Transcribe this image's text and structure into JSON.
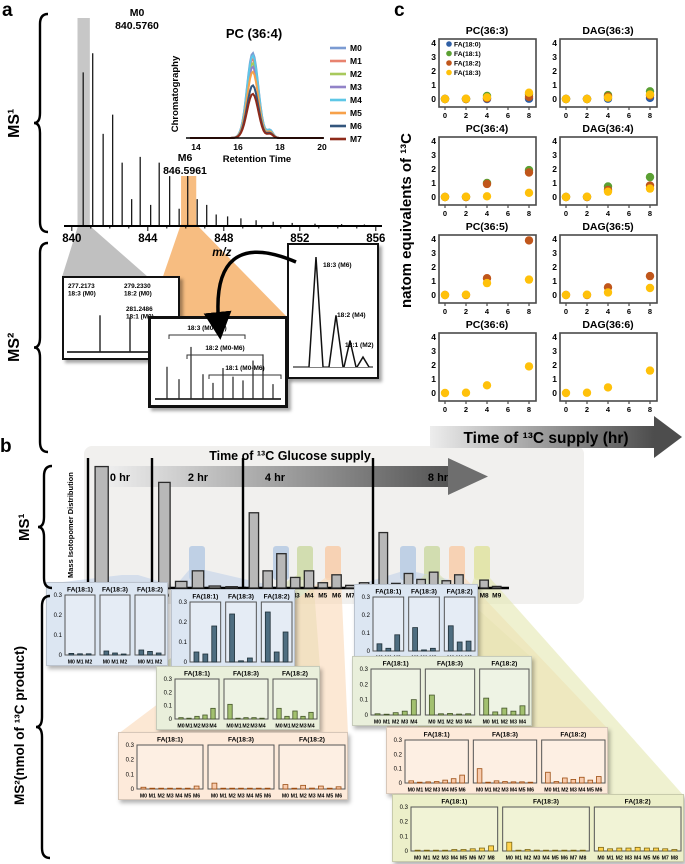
{
  "labels": {
    "a": "a",
    "b": "b",
    "c": "c"
  },
  "panel_a": {
    "ms1_side": "MS¹",
    "ms2_side": "MS²",
    "annotations": {
      "m0_name": "M0",
      "m0_mass": "840.5760",
      "m6_name": "M6",
      "m6_mass": "846.5961"
    }
  },
  "chart_data": {
    "ms1_spectrum": {
      "type": "line",
      "xlabel": "m/z",
      "xticks": [
        840,
        844,
        848,
        852,
        856
      ],
      "xlim": [
        839.8,
        856.8
      ],
      "peaks": [
        [
          840.6,
          0.8
        ],
        [
          841.1,
          0.9
        ],
        [
          841.65,
          0.48
        ],
        [
          842.15,
          0.58
        ],
        [
          842.65,
          0.33
        ],
        [
          843.15,
          0.14
        ],
        [
          843.6,
          0.36
        ],
        [
          844.15,
          0.11
        ],
        [
          844.6,
          0.33
        ],
        [
          845.15,
          0.26
        ],
        [
          845.65,
          0.09
        ],
        [
          846.1,
          0.29
        ],
        [
          846.6,
          0.14
        ],
        [
          847.1,
          0.11
        ],
        [
          847.6,
          0.06
        ],
        [
          848.2,
          0.05
        ],
        [
          848.9,
          0.04
        ],
        [
          849.7,
          0.03
        ],
        [
          850.6,
          0.022
        ],
        [
          851.6,
          0.016
        ],
        [
          852.8,
          0.012
        ],
        [
          854.2,
          0.01
        ],
        [
          855.4,
          0.008
        ]
      ],
      "highlight_gray_mz": [
        840.3,
        840.95
      ],
      "highlight_orange_mz": [
        845.75,
        846.55
      ]
    },
    "chromatogram": {
      "type": "line",
      "title": "PC (36:4)",
      "ylabel": "Chromatography",
      "xlabel": "Retention Time",
      "xticks": [
        14,
        16,
        18,
        20
      ],
      "peak_retention_time": 16.7,
      "series": [
        {
          "name": "M0",
          "color": "#7b9bd2",
          "height": 1.0
        },
        {
          "name": "M1",
          "color": "#e8836f",
          "height": 0.93
        },
        {
          "name": "M2",
          "color": "#a8c95c",
          "height": 0.88
        },
        {
          "name": "M3",
          "color": "#9283c8",
          "height": 0.84
        },
        {
          "name": "M4",
          "color": "#5ec7e6",
          "height": 0.97
        },
        {
          "name": "M5",
          "color": "#f7a14a",
          "height": 0.78
        },
        {
          "name": "M6",
          "color": "#33567d",
          "height": 0.62
        },
        {
          "name": "M7",
          "color": "#8e2a1a",
          "height": 0.52
        }
      ]
    },
    "ms2_fragment_box": {
      "type": "line",
      "peaks": [
        {
          "mass": "277.2173",
          "label": "18:3 (M0)",
          "h": 0.76
        },
        {
          "mass": "279.2330",
          "label": "18:2 (M0)",
          "h": 0.73
        },
        {
          "mass": "281.2486",
          "label": "18:1 (M0)",
          "h": 0.42
        }
      ]
    },
    "ms2_mix_box": {
      "type": "line",
      "brackets": [
        "18:3 (M0-M6)",
        "18:2 (M0-M6)",
        "18:1 (M0-M6)"
      ],
      "peak_heights": [
        0.52,
        0.32,
        0.84,
        0.4,
        0.26,
        0.5,
        0.36,
        0.3,
        0.62,
        0.72,
        0.24
      ]
    },
    "ms2_shift_box": {
      "type": "line",
      "peaks": [
        {
          "label": "18:3 (M6)",
          "h": 1.0
        },
        {
          "label": "18:2 (M4)",
          "h": 0.47
        },
        {
          "label": "18:1 (M2)",
          "h": 0.24
        },
        {
          "label": "",
          "h": 0.09
        }
      ]
    },
    "panel_c": {
      "type": "scatter",
      "ylabel": "natom equivalents of ¹³C",
      "xarrow": "Time of ¹³C supply (hr)",
      "x": [
        0,
        2,
        4,
        8
      ],
      "xticks": [
        0,
        2,
        4,
        6,
        8
      ],
      "yticks": [
        0,
        1,
        2,
        3,
        4
      ],
      "ylim": [
        0,
        4.4
      ],
      "legend": [
        {
          "name": "FA(18:0)",
          "color": "#2f5fa5"
        },
        {
          "name": "FA(18:1)",
          "color": "#5ba033"
        },
        {
          "name": "FA(18:2)",
          "color": "#c0561b"
        },
        {
          "name": "FA(18:3)",
          "color": "#ffc10a"
        }
      ],
      "plots": [
        {
          "title": "PC(36:3)",
          "legend": true,
          "series": [
            {
              "name": "FA(18:0)",
              "values": [
                0,
                0,
                0,
                0.02
              ]
            },
            {
              "name": "FA(18:1)",
              "values": [
                0,
                0,
                0.22,
                0.32
              ]
            },
            {
              "name": "FA(18:2)",
              "values": [
                0,
                0,
                0.05,
                0.15
              ]
            },
            {
              "name": "FA(18:3)",
              "values": [
                0,
                0.02,
                0.12,
                0.45
              ]
            }
          ]
        },
        {
          "title": "DAG(36:3)",
          "series": [
            {
              "name": "FA(18:0)",
              "values": [
                0,
                0,
                0.02,
                0.08
              ]
            },
            {
              "name": "FA(18:1)",
              "values": [
                0,
                0,
                0.28,
                0.55
              ]
            },
            {
              "name": "FA(18:2)",
              "values": [
                0,
                0,
                0.18,
                0.25
              ]
            },
            {
              "name": "FA(18:3)",
              "values": [
                0,
                0,
                0.1,
                0.32
              ]
            }
          ]
        },
        {
          "title": "PC(36:4)",
          "series": [
            {
              "name": "FA(18:1)",
              "values": [
                0,
                0,
                1.0,
                1.92
              ]
            },
            {
              "name": "FA(18:2)",
              "values": [
                0,
                0,
                0.93,
                1.75
              ]
            },
            {
              "name": "FA(18:3)",
              "values": [
                0,
                0.02,
                0.05,
                0.3
              ]
            }
          ]
        },
        {
          "title": "DAG(36:4)",
          "series": [
            {
              "name": "FA(18:1)",
              "values": [
                0,
                0,
                0.75,
                1.42
              ]
            },
            {
              "name": "FA(18:2)",
              "values": [
                0,
                0,
                0.5,
                0.82
              ]
            },
            {
              "name": "FA(18:3)",
              "values": [
                0,
                0.02,
                0.38,
                0.6
              ]
            }
          ]
        },
        {
          "title": "PC(36:5)",
          "series": [
            {
              "name": "FA(18:2)",
              "values": [
                0,
                0,
                1.2,
                3.9
              ]
            },
            {
              "name": "FA(18:3)",
              "values": [
                0,
                0.02,
                0.85,
                1.1
              ]
            }
          ]
        },
        {
          "title": "DAG(36:5)",
          "series": [
            {
              "name": "FA(18:2)",
              "values": [
                0,
                0,
                0.55,
                1.35
              ]
            },
            {
              "name": "FA(18:3)",
              "values": [
                0,
                0.02,
                0.18,
                0.5
              ]
            }
          ]
        },
        {
          "title": "PC(36:6)",
          "series": [
            {
              "name": "FA(18:3)",
              "values": [
                0,
                0.02,
                0.55,
                1.9
              ]
            }
          ]
        },
        {
          "title": "DAG(36:6)",
          "series": [
            {
              "name": "FA(18:3)",
              "values": [
                0,
                0.02,
                0.4,
                1.6
              ]
            }
          ]
        }
      ]
    },
    "panel_b": {
      "type": "bar",
      "header": "Time of ¹³C Glucose supply",
      "ms1_side": "MS¹",
      "ms2_side": "MS²(nmol of ¹³C product)",
      "ms1_ylabel": "Mass Isotopomer Distribution",
      "ms1_times": [
        {
          "label": "0 hr",
          "cats": [
            "M0",
            "M1",
            "M2"
          ],
          "values": [
            0.92,
            0.02,
            0.012
          ]
        },
        {
          "label": "2 hr",
          "cats": [
            "M0",
            "M1",
            "M2",
            "M3",
            "M4"
          ],
          "values": [
            0.8,
            0.05,
            0.13,
            0.015,
            0.01
          ]
        },
        {
          "label": "4 hr",
          "cats": [
            "M0",
            "M1",
            "M2",
            "M3",
            "M4",
            "M5",
            "M6",
            "M7",
            "M8"
          ],
          "values": [
            0.57,
            0.13,
            0.26,
            0.08,
            0.13,
            0.04,
            0.1,
            0.02,
            0.04
          ]
        },
        {
          "label": "8 hr",
          "cats": [
            "M0",
            "M1",
            "M2",
            "M3",
            "M4",
            "M5",
            "M6",
            "M7",
            "M8",
            "M9"
          ],
          "values": [
            0.42,
            0.035,
            0.11,
            0.065,
            0.12,
            0.055,
            0.1,
            0.025,
            0.06,
            0.012
          ]
        }
      ],
      "ms2_yticks": [
        0,
        0.1,
        0.2,
        0.3
      ],
      "ms2_boxes": [
        {
          "id": "blue-0hr",
          "bg": "#dce6f2",
          "bar": "#4e6d80",
          "edge": "#1f3038",
          "cats": [
            "M0",
            "M1",
            "M2"
          ],
          "charts": [
            {
              "title": "FA(18:1)",
              "values": [
                0.008,
                0.006,
                0.006
              ]
            },
            {
              "title": "FA(18:3)",
              "values": [
                0.02,
                0.01,
                0.005
              ]
            },
            {
              "title": "FA(18:2)",
              "values": [
                0.025,
                0.018,
                0.01
              ]
            }
          ]
        },
        {
          "id": "blue-2hr",
          "bg": "#dce6f2",
          "bar": "#4e6d80",
          "edge": "#1f3038",
          "cats": [
            "M0",
            "M1",
            "M2"
          ],
          "charts": [
            {
              "title": "FA(18:1)",
              "values": [
                0.05,
                0.04,
                0.18
              ]
            },
            {
              "title": "FA(18:3)",
              "values": [
                0.24,
                0.006,
                0.02
              ]
            },
            {
              "title": "FA(18:2)",
              "values": [
                0.25,
                0.05,
                0.15
              ]
            }
          ]
        },
        {
          "id": "blue-late",
          "bg": "#dce6f2",
          "bar": "#4e6d80",
          "edge": "#1f3038",
          "cats": [
            "M0",
            "M1",
            "M2"
          ],
          "charts": [
            {
              "title": "FA(18:1)",
              "values": [
                0.04,
                0.015,
                0.09
              ]
            },
            {
              "title": "FA(18:3)",
              "values": [
                0.13,
                0.006,
                0.015
              ]
            },
            {
              "title": "FA(18:2)",
              "values": [
                0.14,
                0.05,
                0.055
              ]
            }
          ]
        },
        {
          "id": "green-4hr",
          "bg": "#e9efdb",
          "bar": "#a2c06f",
          "edge": "#44552a",
          "cats": [
            "M0",
            "M1",
            "M2",
            "M3",
            "M4"
          ],
          "charts": [
            {
              "title": "FA(18:1)",
              "values": [
                0.01,
                0.006,
                0.02,
                0.03,
                0.08
              ]
            },
            {
              "title": "FA(18:3)",
              "values": [
                0.11,
                0.006,
                0.01,
                0.01,
                0.006
              ]
            },
            {
              "title": "FA(18:2)",
              "values": [
                0.08,
                0.02,
                0.06,
                0.02,
                0.05
              ]
            }
          ]
        },
        {
          "id": "green-8hr",
          "bg": "#e9efdb",
          "bar": "#a2c06f",
          "edge": "#44552a",
          "cats": [
            "M0",
            "M1",
            "M2",
            "M3",
            "M4"
          ],
          "charts": [
            {
              "title": "FA(18:1)",
              "values": [
                0.008,
                0.005,
                0.015,
                0.025,
                0.1
              ]
            },
            {
              "title": "FA(18:3)",
              "values": [
                0.13,
                0.008,
                0.01,
                0.006,
                0.008
              ]
            },
            {
              "title": "FA(18:2)",
              "values": [
                0.11,
                0.02,
                0.045,
                0.025,
                0.06
              ]
            }
          ]
        },
        {
          "id": "orange-4hr",
          "bg": "#fdeada",
          "bar": "#f8cbad",
          "edge": "#9c4d12",
          "cats": [
            "M0",
            "M1",
            "M2",
            "M3",
            "M4",
            "M5",
            "M6"
          ],
          "charts": [
            {
              "title": "FA(18:1)",
              "values": [
                0.012,
                0.002,
                0.003,
                0.003,
                0.004,
                0.005,
                0.02
              ]
            },
            {
              "title": "FA(18:3)",
              "values": [
                0.04,
                0.002,
                0.005,
                0.003,
                0.003,
                0.002,
                0.002
              ]
            },
            {
              "title": "FA(18:2)",
              "values": [
                0.03,
                0.005,
                0.025,
                0.006,
                0.02,
                0.005,
                0.015
              ]
            }
          ]
        },
        {
          "id": "orange-8hr",
          "bg": "#fdeada",
          "bar": "#f8cbad",
          "edge": "#9c4d12",
          "cats": [
            "M0",
            "M1",
            "M2",
            "M3",
            "M4",
            "M5",
            "M6"
          ],
          "charts": [
            {
              "title": "FA(18:1)",
              "values": [
                0.015,
                0.003,
                0.008,
                0.01,
                0.02,
                0.03,
                0.055
              ]
            },
            {
              "title": "FA(18:3)",
              "values": [
                0.1,
                0.004,
                0.015,
                0.01,
                0.008,
                0.008,
                0.004
              ]
            },
            {
              "title": "FA(18:2)",
              "values": [
                0.075,
                0.01,
                0.035,
                0.025,
                0.04,
                0.02,
                0.045
              ]
            }
          ]
        },
        {
          "id": "yellow-8hr",
          "bg": "#ecefc9",
          "bar": "#ffd34f",
          "edge": "#7a6614",
          "cats": [
            "M0",
            "M1",
            "M2",
            "M3",
            "M4",
            "M5",
            "M6",
            "M7",
            "M8"
          ],
          "charts": [
            {
              "title": "FA(18:1)",
              "values": [
                0.005,
                0.002,
                0.002,
                0.005,
                0.01,
                0.01,
                0.015,
                0.02,
                0.035
              ]
            },
            {
              "title": "FA(18:3)",
              "values": [
                0.06,
                0.004,
                0.01,
                0.006,
                0.004,
                0.003,
                0.003,
                0.003,
                0.002
              ]
            },
            {
              "title": "FA(18:2)",
              "values": [
                0.025,
                0.015,
                0.02,
                0.02,
                0.025,
                0.02,
                0.02,
                0.015,
                0.01
              ]
            }
          ]
        }
      ]
    }
  }
}
